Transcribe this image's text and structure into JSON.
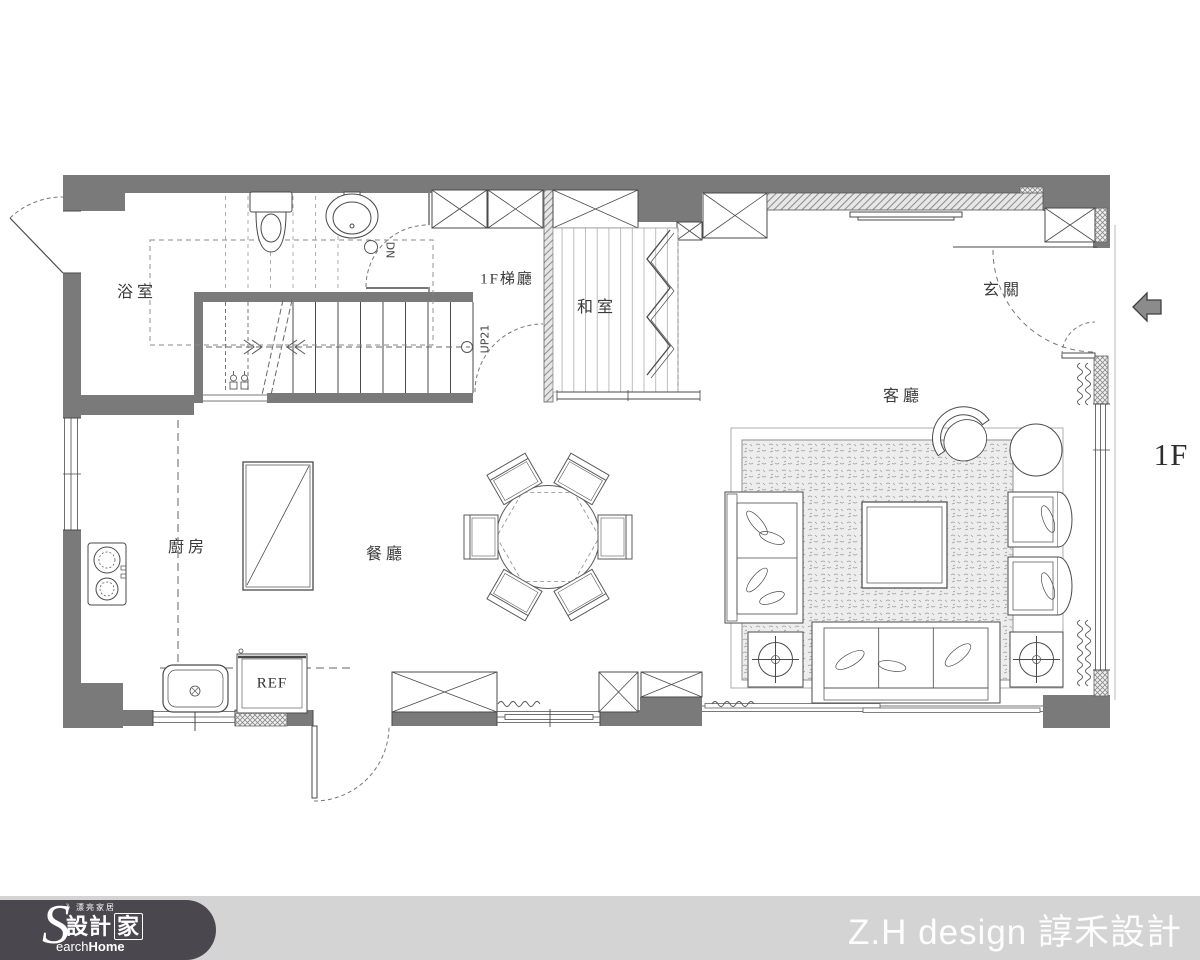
{
  "plan": {
    "floor_label": "1F",
    "rooms": {
      "bathroom": "浴室",
      "stair_hall": "1F梯廳",
      "tatami_room": "和室",
      "entry": "玄關",
      "living_room": "客廳",
      "kitchen": "廚房",
      "dining_room": "餐廳"
    },
    "annotations": {
      "stairs_up": "UP21",
      "stairs_down": "DN",
      "refrigerator": "REF"
    }
  },
  "footer": {
    "watermark": "Z.H design 諄禾設計",
    "logo": {
      "tagline": "》漂亮家居",
      "initial": "S",
      "brand_cjk_1": "設計",
      "brand_cjk_2": "家",
      "brand_latin": "earch",
      "brand_latin_bold": "Home"
    }
  },
  "colors": {
    "wall_fill": "#7a7a7a",
    "line": "#4a4a4a",
    "footer_bar": "#d4d4d4",
    "footer_pill": "#4b474e",
    "label_text": "#3a3a3a",
    "watermark_text": "#ffffff"
  }
}
